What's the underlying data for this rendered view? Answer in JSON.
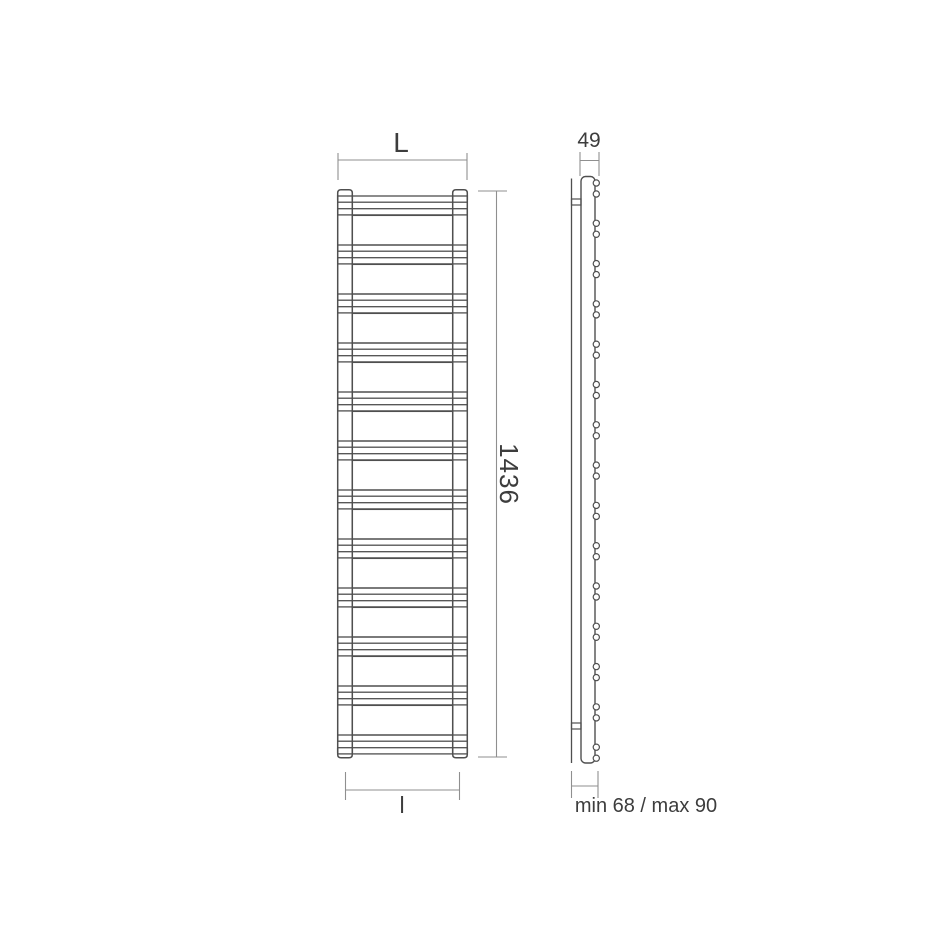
{
  "labels": {
    "width_top": "L",
    "height": "1436",
    "depth": "49",
    "width_bottom": "l",
    "wall_distance": "min 68 / max 90"
  },
  "drawing": {
    "front_view": {
      "panels": 11,
      "rung_groups": 12,
      "bars_per_group": 2
    },
    "side_view": {
      "tube_pairs": 15,
      "circles_per_pair": 2,
      "wall_brackets": 2
    },
    "colors": {
      "outline": "#4f4f4f",
      "dimension": "#8f8f8f",
      "text": "#3d3d3d",
      "background": "#ffffff"
    }
  }
}
